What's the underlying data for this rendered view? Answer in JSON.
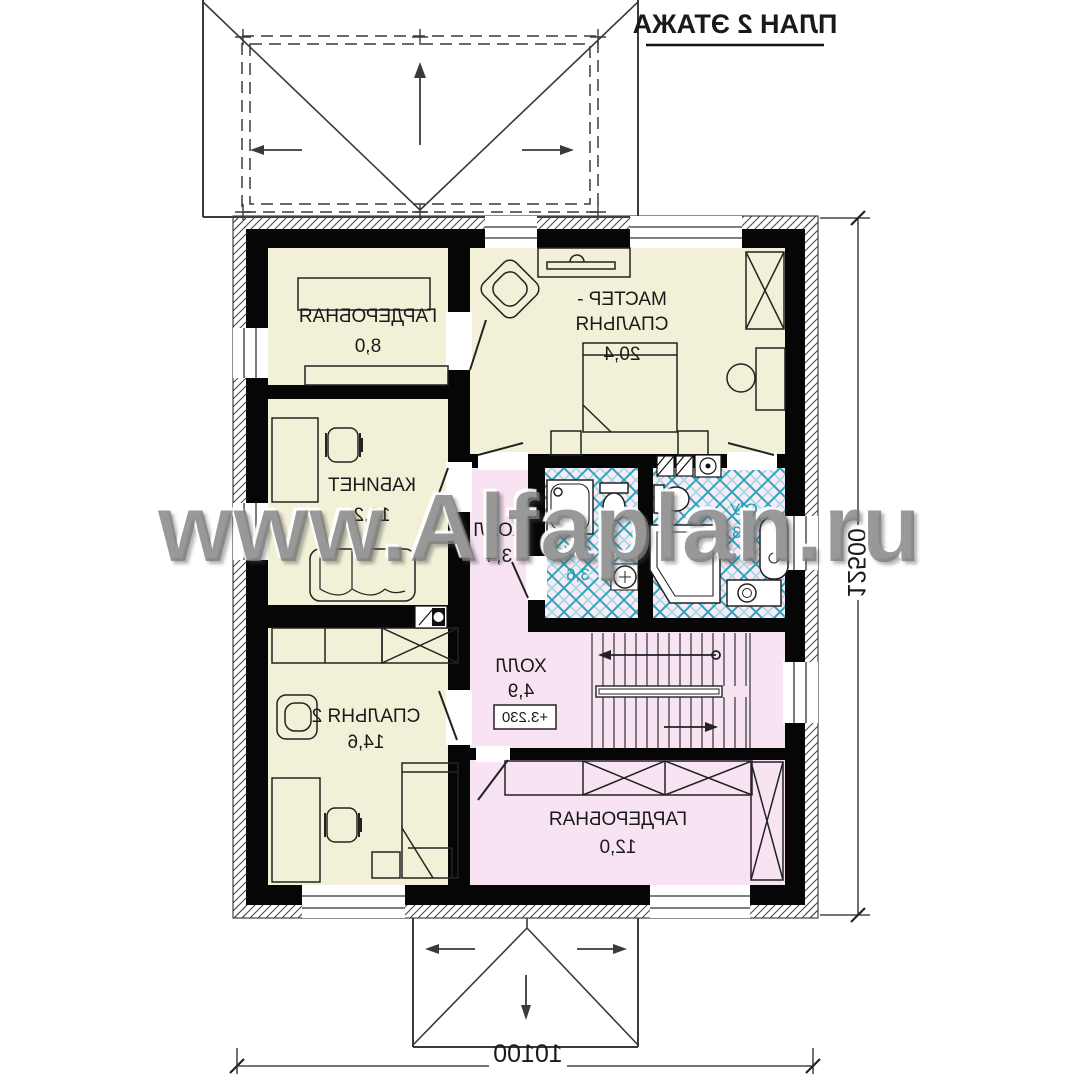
{
  "title": "ПЛАН 2 ЭТАЖА",
  "watermark": "www.Alfaplan.ru",
  "rooms": {
    "wardrobe_top": {
      "name": "ГАРДЕРОБНАЯ",
      "area": "8,0"
    },
    "master_bedroom": {
      "name_line1": "МАСТЕР -",
      "name_line2": "СПАЛЬНЯ",
      "area": "20,4"
    },
    "study": {
      "name": "КАБИНЕТ",
      "area": "12,2"
    },
    "hall_upper": {
      "name": "ХОЛЛ",
      "area": "3,4"
    },
    "bathroom_small": {
      "name": "С/У",
      "area": "3,6"
    },
    "bathroom_master": {
      "name": "С/У",
      "area": "5,3"
    },
    "bedroom2": {
      "name": "СПАЛЬНЯ 2",
      "area": "14,6"
    },
    "hall_stairs": {
      "name": "ХОЛЛ",
      "area": "4,9",
      "level_mark": "+3.230"
    },
    "wardrobe_bottom": {
      "name": "ГАРДЕРОБНАЯ",
      "area": "12,0"
    }
  },
  "dimensions": {
    "bottom": "10100",
    "right": "12500"
  },
  "colors": {
    "room_cream": "#f2f0d6",
    "room_pink": "#f8e3f2",
    "bath_pink": "#fbeaf6",
    "tile_teal": "#2aa4ba",
    "wall_black": "#060606"
  }
}
